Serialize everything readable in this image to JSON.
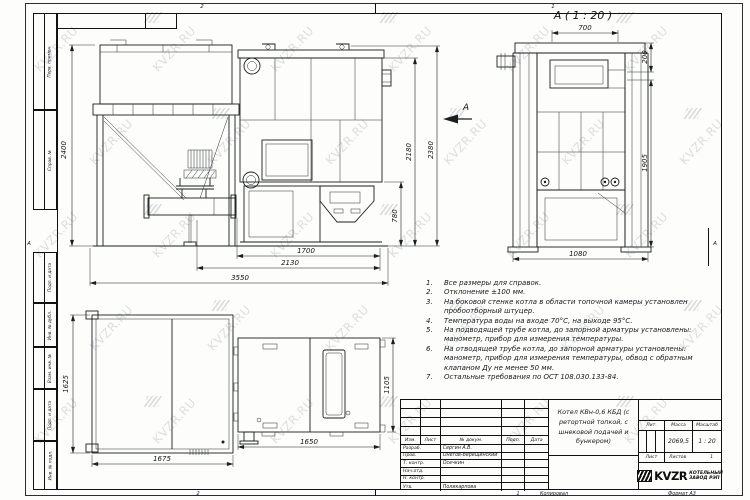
{
  "watermark": {
    "text": "KVZR.RU"
  },
  "frame": {
    "zone_letter_left": "А",
    "zone_letter_right": "А",
    "zone_top_2": "2",
    "zone_top_1": "1",
    "zone_bottom_2": "2",
    "zone_bottom_1": "1",
    "copied_label": "Копировал",
    "format_label": "Формат А3",
    "margin_labels": [
      "Перв. примен.",
      "Справ. №",
      "Подп. и дата",
      "Инв. № дубл.",
      "Взам. инв. №",
      "Подп. и дата",
      "Инв. № подл."
    ]
  },
  "views": {
    "detail_title": "А ( 1 : 20 )",
    "view_arrow_label": "А",
    "front_dims": {
      "h_bunker": "2400",
      "h_total": "2380",
      "h_body": "2180",
      "h_ash": "780",
      "w_body": "1700",
      "w_mid": "2130",
      "w_total": "3550"
    },
    "detail_dims": {
      "w_top": "700",
      "h_top": "200",
      "h_side": "1905",
      "w_bottom": "1080"
    },
    "plan_dims": {
      "h_bunker": "1625",
      "w_bunker": "1675",
      "w_boiler": "1650",
      "h_boiler": "1105"
    }
  },
  "notes": {
    "items": [
      {
        "n": "1.",
        "text": "Все размеры для справок."
      },
      {
        "n": "2.",
        "text": "Отклонение ±100 мм."
      },
      {
        "n": "3.",
        "text": "На боковой стенке котла в области топочной камеры установлен пробоотборный штуцер."
      },
      {
        "n": "4.",
        "text": "Температура воды на входе 70°С, на выходе 95°С."
      },
      {
        "n": "5.",
        "text": "На подводящей трубе котла, до запорной арматуры установлены: манометр, прибор для измерения температуры."
      },
      {
        "n": "6.",
        "text": "На отводящей трубе котла, до запорной арматуры установлены: манометр, прибор для измерения температуры, обвод с обратным клапаном Ду не менее 50 мм."
      },
      {
        "n": "7.",
        "text": "Остальные требования по ОСТ 108.030.133-84."
      }
    ]
  },
  "titleblock": {
    "header": {
      "izm": "Изм.",
      "list": "Лист",
      "doc": "№ докум.",
      "sign": "Подп.",
      "date": "Дата"
    },
    "rows": [
      {
        "label": "Разраб.",
        "name": "Сергин А.В."
      },
      {
        "label": "Пров.",
        "name": "Онегов-Верещинский"
      },
      {
        "label": "Т. контр.",
        "name": "Осечкин"
      },
      {
        "label": "Нач.отд.",
        "name": ""
      },
      {
        "label": "Н. контр.",
        "name": ""
      },
      {
        "label": "Утв.",
        "name": "Поликарпова"
      }
    ],
    "title": "Котел КВн-0,6 КБД (с ретортной топкой, с шнековой подачей и бункером)",
    "lit_label": "Лит.",
    "mass_label": "Масса",
    "scale_label": "Масштаб",
    "mass_value": "2069,5",
    "scale_value": "1 : 20",
    "sheet_label": "Лист",
    "sheets_label": "Листов",
    "sheets_value": "1",
    "company": {
      "logo": "KVZR",
      "line1": "КОТЕЛЬНЫЙ",
      "line2": "ЗАВОД РЭП"
    }
  }
}
